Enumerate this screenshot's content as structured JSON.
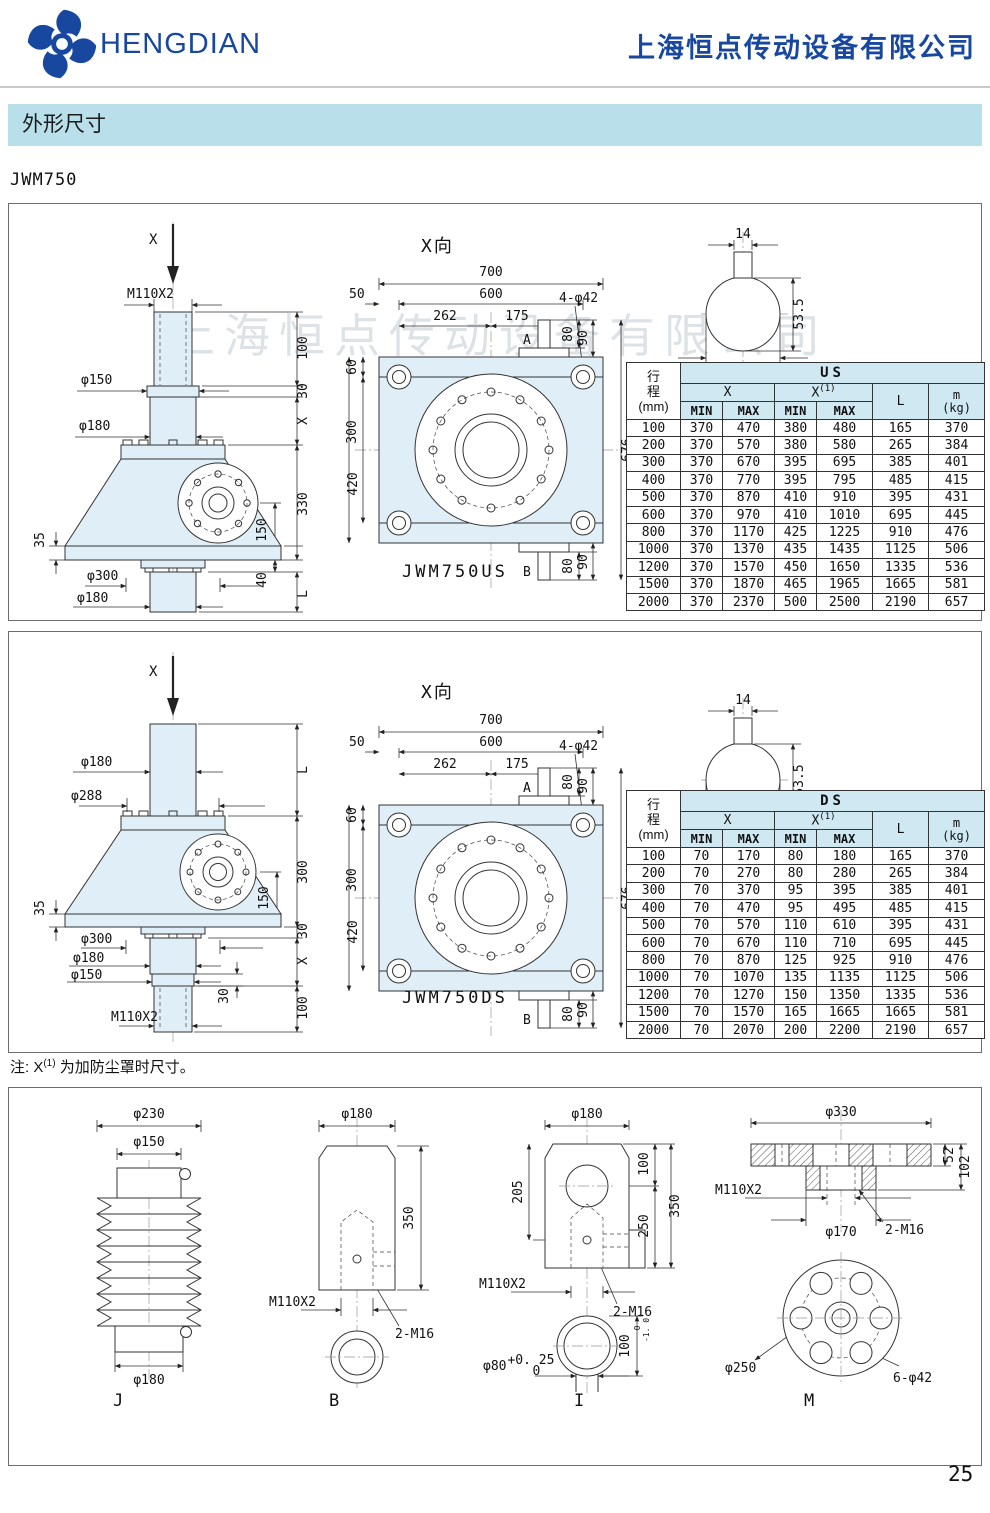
{
  "header": {
    "brand": "HENGDIAN",
    "company": "上海恒点传动设备有限公司",
    "brand_color": "#17479e"
  },
  "section_title": "外形尺寸",
  "model": "JWM750",
  "watermark": "上海恒点传动设备有限公司",
  "note": {
    "prefix": "注: X",
    "sup": "(1)",
    "text": " 为加防尘罩时尺寸。"
  },
  "page_number": "25",
  "view_label": "X向",
  "drawing_labels": {
    "us": "JWM750US",
    "ds": "JWM750DS"
  },
  "shaft_view": {
    "w14": "14",
    "h535": "53.5",
    "dia": "φ50h7"
  },
  "top_view": {
    "d700": "700",
    "d600": "600",
    "d262": "262",
    "d175": "175",
    "d50": "50",
    "bolt": "4-φ42",
    "a": "A",
    "b": "B",
    "d60": "60",
    "d420": "420",
    "d300": "300",
    "d676": "676",
    "d80": "80",
    "d90": "90"
  },
  "us_side": {
    "x": "X",
    "m110": "M110X2",
    "d150": "φ150",
    "d180t": "φ180",
    "d35": "35",
    "d300": "φ300",
    "d180b": "φ180",
    "c100": "100",
    "c30": "30",
    "cx": "X",
    "c330": "330",
    "c150": "150",
    "c40": "40",
    "cl": "L"
  },
  "ds_side": {
    "x": "X",
    "d180t": "φ180",
    "d288": "φ288",
    "d35": "35",
    "d300": "φ300",
    "d180m": "φ180",
    "d150": "φ150",
    "d30i": "30",
    "m110": "M110X2",
    "cl": "L",
    "c300": "300",
    "c150": "150",
    "c30": "30",
    "cx": "X",
    "c100": "100"
  },
  "table_us": {
    "rowhead": "行\n程\n(mm)",
    "group": "US",
    "x": "X",
    "x1": "X",
    "x1sup": "(1)",
    "min": "MIN",
    "max": "MAX",
    "l": "L",
    "m": "m\n(kg)",
    "rows": [
      [
        "100",
        "370",
        "470",
        "380",
        "480",
        "165",
        "370"
      ],
      [
        "200",
        "370",
        "570",
        "380",
        "580",
        "265",
        "384"
      ],
      [
        "300",
        "370",
        "670",
        "395",
        "695",
        "385",
        "401"
      ],
      [
        "400",
        "370",
        "770",
        "395",
        "795",
        "485",
        "415"
      ],
      [
        "500",
        "370",
        "870",
        "410",
        "910",
        "395",
        "431"
      ],
      [
        "600",
        "370",
        "970",
        "410",
        "1010",
        "695",
        "445"
      ],
      [
        "800",
        "370",
        "1170",
        "425",
        "1225",
        "910",
        "476"
      ],
      [
        "1000",
        "370",
        "1370",
        "435",
        "1435",
        "1125",
        "506"
      ],
      [
        "1200",
        "370",
        "1570",
        "450",
        "1650",
        "1335",
        "536"
      ],
      [
        "1500",
        "370",
        "1870",
        "465",
        "1965",
        "1665",
        "581"
      ],
      [
        "2000",
        "370",
        "2370",
        "500",
        "2500",
        "2190",
        "657"
      ]
    ]
  },
  "table_ds": {
    "rowhead": "行\n程\n(mm)",
    "group": "DS",
    "x": "X",
    "x1": "X",
    "x1sup": "(1)",
    "min": "MIN",
    "max": "MAX",
    "l": "L",
    "m": "m\n(kg)",
    "rows": [
      [
        "100",
        "70",
        "170",
        "80",
        "180",
        "165",
        "370"
      ],
      [
        "200",
        "70",
        "270",
        "80",
        "280",
        "265",
        "384"
      ],
      [
        "300",
        "70",
        "370",
        "95",
        "395",
        "385",
        "401"
      ],
      [
        "400",
        "70",
        "470",
        "95",
        "495",
        "485",
        "415"
      ],
      [
        "500",
        "70",
        "570",
        "110",
        "610",
        "395",
        "431"
      ],
      [
        "600",
        "70",
        "670",
        "110",
        "710",
        "695",
        "445"
      ],
      [
        "800",
        "70",
        "870",
        "125",
        "925",
        "910",
        "476"
      ],
      [
        "1000",
        "70",
        "1070",
        "135",
        "1135",
        "1125",
        "506"
      ],
      [
        "1200",
        "70",
        "1270",
        "150",
        "1350",
        "1335",
        "536"
      ],
      [
        "1500",
        "70",
        "1570",
        "165",
        "1665",
        "1665",
        "581"
      ],
      [
        "2000",
        "70",
        "2070",
        "200",
        "2200",
        "2190",
        "657"
      ]
    ]
  },
  "acc_j": {
    "d230": "φ230",
    "d150": "φ150",
    "d180": "φ180",
    "label": "J"
  },
  "acc_b": {
    "d180": "φ180",
    "h350": "350",
    "m110": "M110X2",
    "m16": "2-M16",
    "label": "B"
  },
  "acc_i": {
    "d180": "φ180",
    "c100": "100",
    "c205": "205",
    "c250": "250",
    "c350": "350",
    "m110": "M110X2",
    "m16": "2-M16",
    "d80": "φ80",
    "d80t1": "+0. 25",
    "d80t2": "0",
    "h100": "100",
    "h100t1": "0",
    "h100t2": "-1. 0",
    "label": "I"
  },
  "acc_m": {
    "d330": "φ330",
    "c52": "52",
    "c102": "102",
    "m110": "M110X2",
    "m16": "2-M16",
    "d170": "φ170",
    "d250": "φ250",
    "bolt": "6-φ42",
    "label": "M"
  }
}
